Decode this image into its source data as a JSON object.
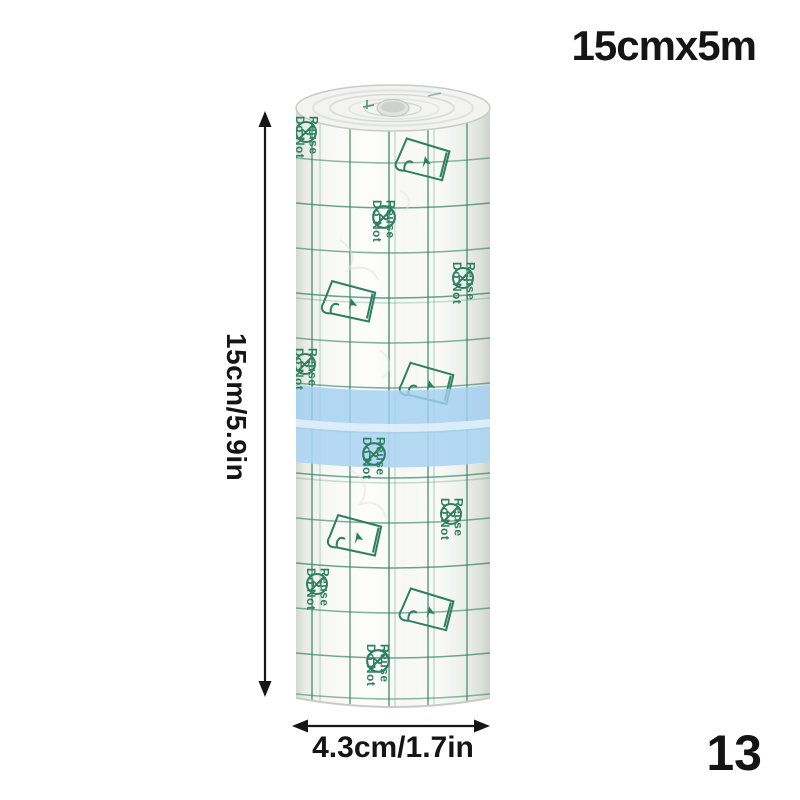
{
  "annotations": {
    "size_label": "15cmx5m",
    "height_label": "15cm/5.9in",
    "width_label": "4.3cm/1.7in",
    "index_label": "13"
  },
  "roll_print": {
    "do_not_line1": "Do Not",
    "do_not_line2": "Reuse",
    "reuse_symbol": "2"
  },
  "colors": {
    "print_green": "#2e7f60",
    "band_blue": "#a2cff1",
    "annotation_black": "#151515",
    "background": "#ffffff"
  }
}
